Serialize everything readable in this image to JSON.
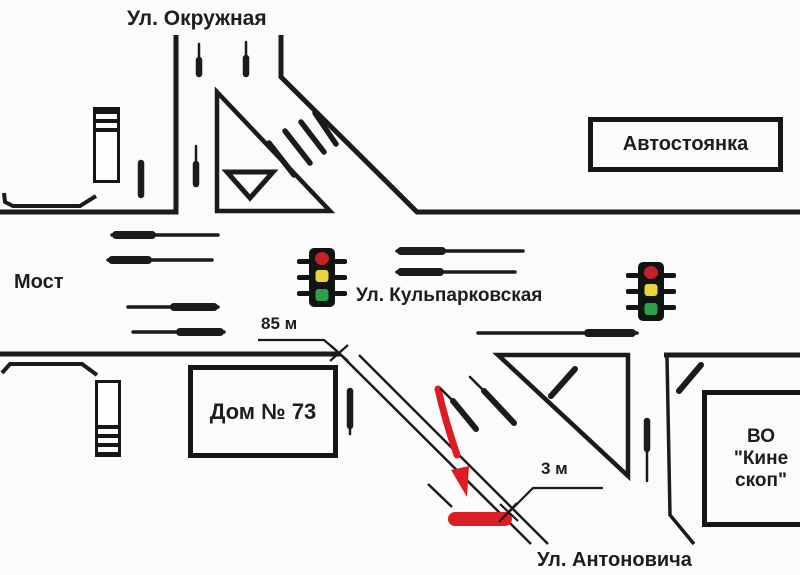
{
  "streets": {
    "okruzhnaya": "Ул. Окружная",
    "kulparkovskaya": "Ул. Кульпарковская",
    "antonovicha": "Ул. Антоновича",
    "most": "Мост"
  },
  "buildings": {
    "avtostoyanka": "Автостоянка",
    "dom": "Дом № 73",
    "kineskop_line1": "ВО",
    "kineskop_line2": "\"Кине",
    "kineskop_line3": "скоп\""
  },
  "measurements": {
    "d85": "85 м",
    "d3": "3 м"
  },
  "icons": {
    "traffic_light": "traffic-light-icon",
    "give_way": "give-way-triangle-icon",
    "crash_arrow": "red-trajectory-arrow-icon",
    "skid_mark": "red-skid-bar-icon"
  },
  "colors": {
    "line": "#1b1b1b",
    "red": "#dc1e24",
    "tl_red": "#c42026",
    "tl_yellow": "#e9d53c",
    "tl_green": "#2da14a",
    "background": "#fbfbfb"
  }
}
